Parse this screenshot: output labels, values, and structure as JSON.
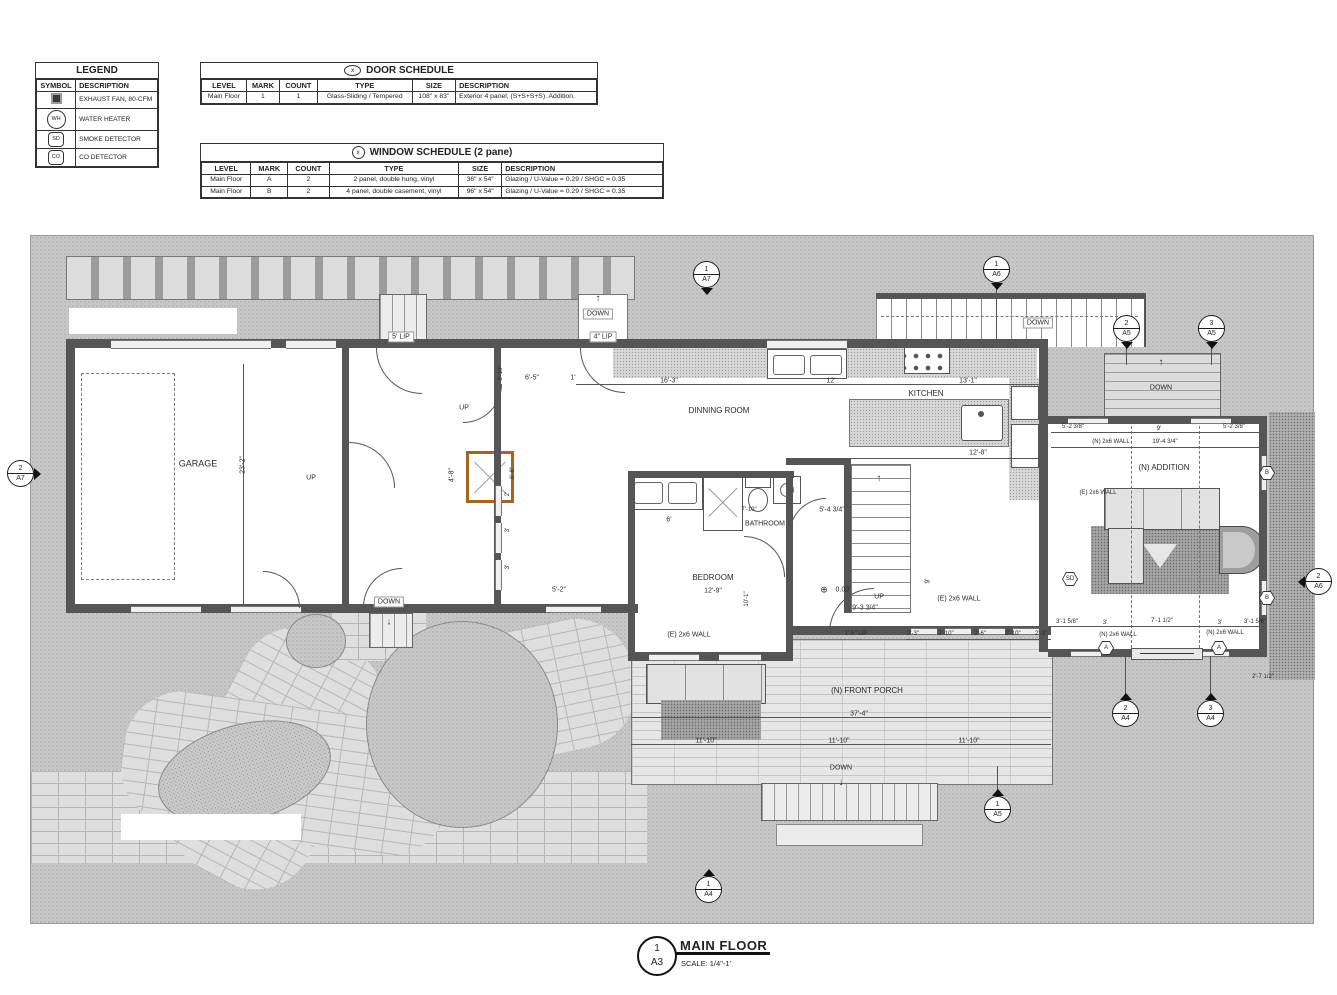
{
  "legend": {
    "title": "LEGEND",
    "headers": [
      "SYMBOL",
      "DESCRIPTION"
    ],
    "rows": [
      {
        "sym": "fan",
        "glyph": "",
        "label": "EXHAUST FAN, 80-CFM"
      },
      {
        "sym": "wh",
        "glyph": "WH",
        "label": "WATER HEATER"
      },
      {
        "sym": "sd",
        "glyph": "SD",
        "label": "SMOKE DETECTOR"
      },
      {
        "sym": "co",
        "glyph": "CO",
        "label": "CO DETECTOR"
      }
    ]
  },
  "door_schedule": {
    "badge": "x",
    "title": "DOOR SCHEDULE",
    "headers": [
      "LEVEL",
      "MARK",
      "COUNT",
      "TYPE",
      "SIZE",
      "DESCRIPTION"
    ],
    "rows": [
      [
        "Main Floor",
        "1",
        "1",
        "Glass-Sliding / Tempered",
        "108\" x 83\"",
        "Exterior 4 panel; (S+S+S+S). Addition."
      ]
    ]
  },
  "window_schedule": {
    "badge": "x",
    "title": "WINDOW SCHEDULE (2 pane)",
    "headers": [
      "LEVEL",
      "MARK",
      "COUNT",
      "TYPE",
      "SIZE",
      "DESCRIPTION"
    ],
    "rows": [
      [
        "Main Floor",
        "A",
        "2",
        "2 panel, double hung, vinyl",
        "36\" x 54\"",
        "Glazing / U-Value = 0.29 / SHGC = 0.35"
      ],
      [
        "Main Floor",
        "B",
        "2",
        "4 panel, double casement, vinyl",
        "96\" x 54\"",
        "Glazing / U-Value = 0.29 / SHGC = 0.35"
      ]
    ]
  },
  "title_block": {
    "number": "1",
    "sheet": "A3",
    "title": "MAIN FLOOR",
    "scale": "SCALE: 1/4\"-1'"
  },
  "plan": {
    "colors": {
      "wall": "#555555",
      "fireplace": "#a8641f",
      "hatch": "#c9c9c9"
    },
    "labels": [
      {
        "t": "GARAGE",
        "x": 167,
        "y": 228,
        "s": 9
      },
      {
        "t": "23'-2\"",
        "x": 212,
        "y": 229,
        "r": -90,
        "s": 7
      },
      {
        "t": "UP",
        "x": 280,
        "y": 242,
        "s": 7
      },
      {
        "t": "DOWN",
        "x": 358,
        "y": 366,
        "s": 7,
        "bg": true
      },
      {
        "t": "↓",
        "x": 358,
        "y": 386,
        "s": 9
      },
      {
        "t": "5' LIP",
        "x": 370,
        "y": 101,
        "s": 7,
        "bg": true
      },
      {
        "t": "DOWN",
        "x": 567,
        "y": 78,
        "s": 7,
        "bg": true
      },
      {
        "t": "↑",
        "x": 567,
        "y": 63,
        "s": 10
      },
      {
        "t": "4\" LIP",
        "x": 572,
        "y": 101,
        "s": 7,
        "bg": true
      },
      {
        "t": "UP",
        "x": 433,
        "y": 172,
        "s": 7
      },
      {
        "t": "6'-5\"",
        "x": 501,
        "y": 142,
        "s": 7
      },
      {
        "t": "1'",
        "x": 542,
        "y": 142,
        "s": 7
      },
      {
        "t": "3'-10\"",
        "x": 470,
        "y": 137,
        "r": -90,
        "s": 6
      },
      {
        "t": "4'-8\"",
        "x": 421,
        "y": 239,
        "r": -90,
        "s": 7
      },
      {
        "t": "6'-8\"",
        "x": 482,
        "y": 237,
        "r": -90,
        "s": 6
      },
      {
        "t": "2'",
        "x": 477,
        "y": 258,
        "r": -90,
        "s": 6
      },
      {
        "t": "3'",
        "x": 477,
        "y": 294,
        "r": -90,
        "s": 6
      },
      {
        "t": "3'",
        "x": 477,
        "y": 331,
        "r": -90,
        "s": 6
      },
      {
        "t": "5'-2\"",
        "x": 528,
        "y": 354,
        "s": 7
      },
      {
        "t": "DINNING ROOM",
        "x": 688,
        "y": 175,
        "s": 8
      },
      {
        "t": "16'-3\"",
        "x": 638,
        "y": 145,
        "s": 7
      },
      {
        "t": "12'",
        "x": 800,
        "y": 145,
        "s": 7
      },
      {
        "t": "13'-1\"",
        "x": 937,
        "y": 145,
        "s": 7
      },
      {
        "t": "KITCHEN",
        "x": 895,
        "y": 158,
        "s": 8
      },
      {
        "t": "12'-8\"",
        "x": 947,
        "y": 217,
        "s": 7
      },
      {
        "t": "DOWN",
        "x": 1007,
        "y": 87,
        "s": 7,
        "bg": true
      },
      {
        "t": "7'-10\"",
        "x": 718,
        "y": 274,
        "s": 6
      },
      {
        "t": "BATHROOM",
        "x": 734,
        "y": 288,
        "s": 7
      },
      {
        "t": "5'-4 3/4\"",
        "x": 801,
        "y": 274,
        "s": 7
      },
      {
        "t": "6'",
        "x": 638,
        "y": 284,
        "s": 7
      },
      {
        "t": "BEDROOM",
        "x": 682,
        "y": 342,
        "s": 8
      },
      {
        "t": "12'-9\"",
        "x": 682,
        "y": 355,
        "s": 7
      },
      {
        "t": "10'-1\"",
        "x": 716,
        "y": 363,
        "r": -90,
        "s": 6
      },
      {
        "t": "(E) 2x6 WALL",
        "x": 658,
        "y": 399,
        "s": 7
      },
      {
        "t": "(E) 2x6 WALL",
        "x": 928,
        "y": 363,
        "s": 7
      },
      {
        "t": "⊕",
        "x": 793,
        "y": 354,
        "s": 9
      },
      {
        "t": "0.00'",
        "x": 812,
        "y": 354,
        "s": 7
      },
      {
        "t": "UP",
        "x": 848,
        "y": 361,
        "s": 7
      },
      {
        "t": "↑",
        "x": 848,
        "y": 243,
        "s": 10
      },
      {
        "t": "9'-3 3/4\"",
        "x": 834,
        "y": 372,
        "s": 7
      },
      {
        "t": "9'",
        "x": 897,
        "y": 345,
        "r": -90,
        "s": 7
      },
      {
        "t": "1'-5\" LIP",
        "x": 825,
        "y": 398,
        "s": 6
      },
      {
        "t": "2'-3\"",
        "x": 882,
        "y": 398,
        "s": 6
      },
      {
        "t": "2'-10\"",
        "x": 915,
        "y": 398,
        "s": 6
      },
      {
        "t": "2'-6\"",
        "x": 949,
        "y": 398,
        "s": 6
      },
      {
        "t": "2'-10\"",
        "x": 982,
        "y": 398,
        "s": 6
      },
      {
        "t": "2'-3\"",
        "x": 1010,
        "y": 398,
        "s": 6
      },
      {
        "t": "(N) FRONT PORCH",
        "x": 836,
        "y": 455,
        "s": 8
      },
      {
        "t": "37'-4\"",
        "x": 828,
        "y": 478,
        "s": 7
      },
      {
        "t": "11'-10\"",
        "x": 675,
        "y": 505,
        "s": 7
      },
      {
        "t": "11'-10\"",
        "x": 808,
        "y": 505,
        "s": 7
      },
      {
        "t": "11'-10\"",
        "x": 938,
        "y": 505,
        "s": 7
      },
      {
        "t": "DOWN",
        "x": 810,
        "y": 532,
        "s": 7
      },
      {
        "t": "↓",
        "x": 810,
        "y": 547,
        "s": 10
      },
      {
        "t": "DOWN",
        "x": 1130,
        "y": 152,
        "s": 7
      },
      {
        "t": "↑",
        "x": 1130,
        "y": 127,
        "s": 10
      },
      {
        "t": "(N) ADDITION",
        "x": 1133,
        "y": 232,
        "s": 8
      },
      {
        "t": "5'-2 3/8\"",
        "x": 1042,
        "y": 191,
        "s": 6
      },
      {
        "t": "9'",
        "x": 1128,
        "y": 193,
        "s": 6
      },
      {
        "t": "5'-2 3/8\"",
        "x": 1203,
        "y": 191,
        "s": 6
      },
      {
        "t": "(N) 2x6 WALL",
        "x": 1080,
        "y": 206,
        "s": 6
      },
      {
        "t": "19'-4 3/4\"",
        "x": 1134,
        "y": 206,
        "s": 6
      },
      {
        "t": "(E) 2x6 WALL",
        "x": 1067,
        "y": 257,
        "s": 6
      },
      {
        "t": "3'-1 5/8\"",
        "x": 1036,
        "y": 386,
        "s": 6
      },
      {
        "t": "3'",
        "x": 1074,
        "y": 387,
        "s": 6
      },
      {
        "t": "7'-1 1/2\"",
        "x": 1131,
        "y": 385,
        "s": 6
      },
      {
        "t": "3'",
        "x": 1189,
        "y": 387,
        "s": 6
      },
      {
        "t": "3'-1 5/8\"",
        "x": 1224,
        "y": 386,
        "s": 6
      },
      {
        "t": "(N) 2x6 WALL",
        "x": 1087,
        "y": 399,
        "s": 6
      },
      {
        "t": "(N) 2x6 WALL",
        "x": 1194,
        "y": 397,
        "s": 6
      },
      {
        "t": "2'-7 1/2\"",
        "x": 1232,
        "y": 441,
        "s": 6
      }
    ],
    "markers": [
      {
        "num": "1",
        "sheet": "A7",
        "x": 675,
        "y": 38,
        "dir": "down"
      },
      {
        "num": "1",
        "sheet": "A6",
        "x": 965,
        "y": 33,
        "dir": "down"
      },
      {
        "num": "2",
        "sheet": "A5",
        "x": 1095,
        "y": 92,
        "dir": "down"
      },
      {
        "num": "3",
        "sheet": "A5",
        "x": 1180,
        "y": 92,
        "dir": "down"
      },
      {
        "num": "2",
        "sheet": "A7",
        "x": -11,
        "y": 237,
        "dir": "right"
      },
      {
        "num": "2",
        "sheet": "A6",
        "x": 1287,
        "y": 345,
        "dir": "left"
      },
      {
        "num": "2",
        "sheet": "A4",
        "x": 1094,
        "y": 477,
        "dir": "up"
      },
      {
        "num": "3",
        "sheet": "A4",
        "x": 1179,
        "y": 477,
        "dir": "up"
      },
      {
        "num": "1",
        "sheet": "A5",
        "x": 966,
        "y": 573,
        "dir": "up"
      },
      {
        "num": "1",
        "sheet": "A4",
        "x": 677,
        "y": 653,
        "dir": "up"
      }
    ],
    "window_tags": [
      {
        "t": "A",
        "x": 1075,
        "y": 412
      },
      {
        "t": "A",
        "x": 1188,
        "y": 412
      },
      {
        "t": "B",
        "x": 1236,
        "y": 237
      },
      {
        "t": "B",
        "x": 1236,
        "y": 362
      }
    ],
    "detectors": [
      {
        "t": "SD",
        "x": 1039,
        "y": 343
      }
    ]
  }
}
